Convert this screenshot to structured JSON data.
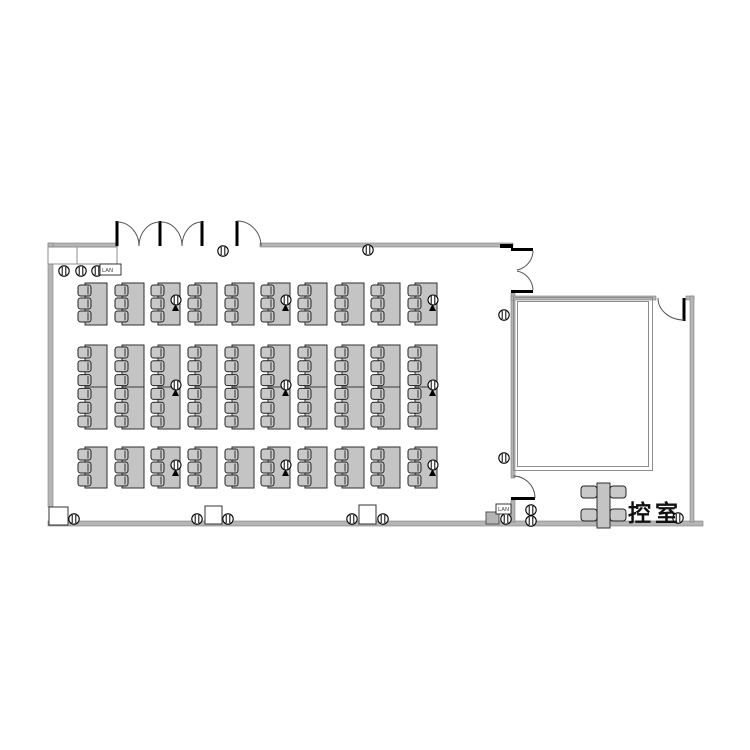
{
  "labels": {
    "waiting_room": "控室",
    "floor_box": "LAN"
  },
  "colors": {
    "wall": "#b5b5b5",
    "wall_edge": "#7f7f7f",
    "furniture_fill": "#c4c4c4",
    "furniture_stroke": "#2f2f2f",
    "door_line": "#000000"
  },
  "floor_plan": {
    "table_grid": {
      "columns_x": [
        85,
        122,
        158,
        195,
        232,
        268,
        305,
        342,
        378,
        415
      ],
      "table_width": 22,
      "chair_w": 13,
      "chair_h": 11,
      "mic_columns": [
        3,
        6,
        10
      ],
      "rows": [
        {
          "name": "front",
          "table_y": 283,
          "table_h": 42,
          "chairs": 3,
          "chair_start_y": 285,
          "chair_pitch": 13,
          "mic_y": 300
        },
        {
          "name": "middle",
          "table_y": 345,
          "table_h": 84,
          "chairs": 6,
          "chair_start_y": 347,
          "chair_pitch": 13.8,
          "mic_y": 385,
          "divider_y": 387
        },
        {
          "name": "back",
          "table_y": 447,
          "table_h": 41,
          "chairs": 3,
          "chair_start_y": 449,
          "chair_pitch": 13,
          "mic_y": 465
        }
      ]
    },
    "outlets": [
      {
        "x": 64,
        "y": 271
      },
      {
        "x": 81,
        "y": 271
      },
      {
        "x": 97,
        "y": 271
      },
      {
        "x": 223,
        "y": 251
      },
      {
        "x": 368,
        "y": 250
      },
      {
        "x": 504,
        "y": 315
      },
      {
        "x": 504,
        "y": 458
      },
      {
        "x": 74,
        "y": 519
      },
      {
        "x": 197,
        "y": 519
      },
      {
        "x": 228,
        "y": 519
      },
      {
        "x": 352,
        "y": 519
      },
      {
        "x": 383,
        "y": 519
      },
      {
        "x": 506,
        "y": 519
      },
      {
        "x": 531,
        "y": 510
      },
      {
        "x": 531,
        "y": 521
      },
      {
        "x": 678,
        "y": 518
      }
    ],
    "pillars": [
      {
        "x": 49,
        "y": 507,
        "w": 19,
        "h": 18
      },
      {
        "x": 205,
        "y": 506,
        "w": 17,
        "h": 18
      },
      {
        "x": 359,
        "y": 505,
        "w": 17,
        "h": 19
      }
    ],
    "gray_box": {
      "x": 486,
      "y": 512,
      "w": 13,
      "h": 12
    },
    "floor_boxes": [
      {
        "x": 100,
        "y": 264,
        "w": 21,
        "h": 11
      },
      {
        "x": 496,
        "y": 504,
        "w": 15,
        "h": 10
      }
    ],
    "meeting_table": {
      "x": 597,
      "y": 483,
      "w": 13,
      "h": 45,
      "chairs": [
        {
          "x": 581,
          "y": 486
        },
        {
          "x": 610,
          "y": 486
        },
        {
          "x": 581,
          "y": 509
        },
        {
          "x": 610,
          "y": 509
        }
      ]
    }
  }
}
